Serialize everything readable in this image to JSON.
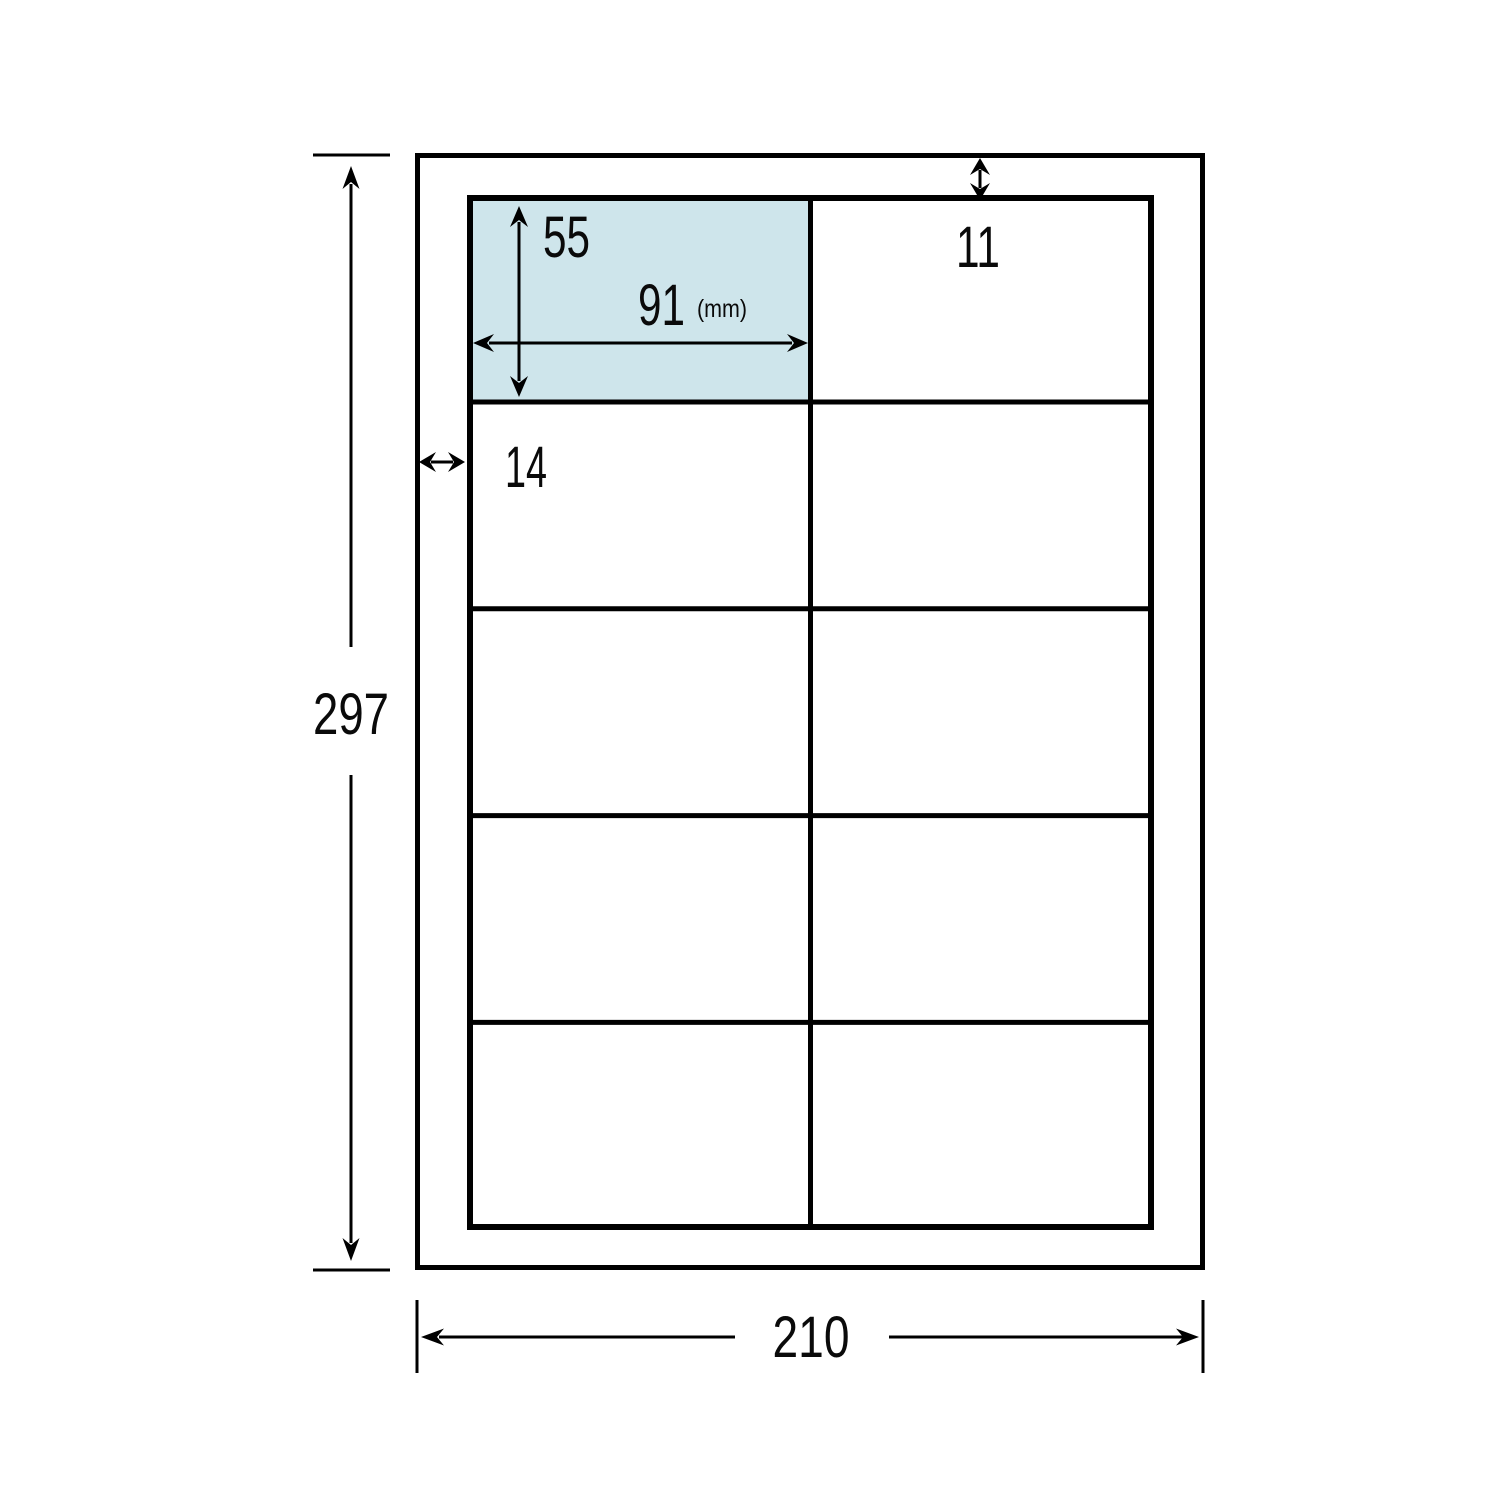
{
  "diagram": {
    "kind": "label-sheet-dimension-diagram",
    "labels": {
      "sheet_height": "297",
      "sheet_width": "210",
      "label_height": "55",
      "label_width": "91",
      "unit": "(mm)",
      "top_margin": "11",
      "left_margin": "14"
    },
    "grid": {
      "rows": 5,
      "columns": 2
    },
    "colors": {
      "highlight": "#CEE5EB",
      "line": "#000000",
      "background": "#FFFFFF"
    }
  }
}
